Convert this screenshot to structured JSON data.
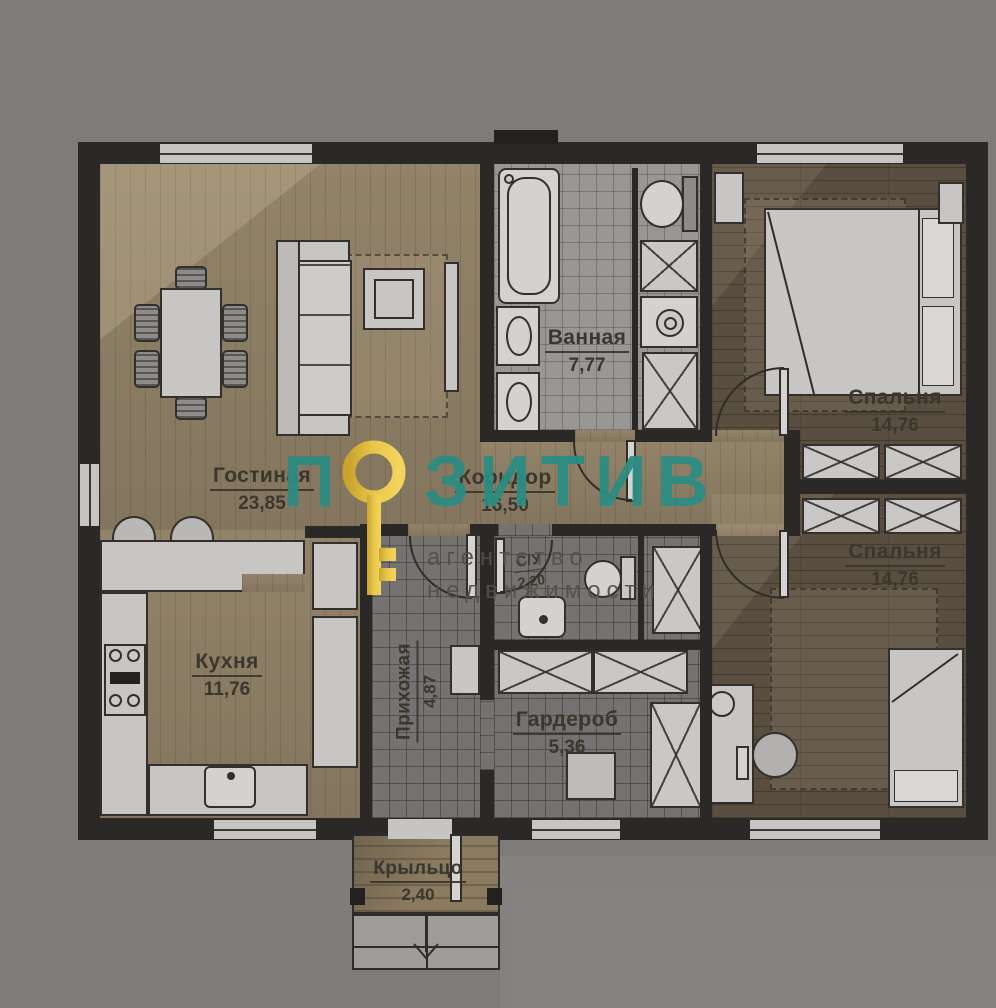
{
  "watermark": {
    "brand_prefix": "П",
    "brand_suffix": "ЗИТИВ",
    "brand_full": "ПОЗИТИВ",
    "tagline_line1": "агентство",
    "tagline_line2": "недвижимости",
    "brand_color": "#2c8c82",
    "key_color": "#e8c84a"
  },
  "rooms": {
    "living": {
      "name": "Гостиная",
      "area": "23,85"
    },
    "kitchen": {
      "name": "Кухня",
      "area": "11,76"
    },
    "bathroom": {
      "name": "Ванная",
      "area": "7,77"
    },
    "corridor": {
      "name": "Коридор",
      "area": "16,50"
    },
    "hallway": {
      "name": "Прихожая",
      "area": "4,87"
    },
    "wc": {
      "name": "С/У",
      "area": "2,20"
    },
    "wardrobe": {
      "name": "Гардероб",
      "area": "5,36"
    },
    "bedroom_top": {
      "name": "Спальня",
      "area": "14,76"
    },
    "bedroom_bottom": {
      "name": "Спальня",
      "area": "14,76"
    },
    "porch": {
      "name": "Крыльцо",
      "area": "2,40"
    }
  }
}
